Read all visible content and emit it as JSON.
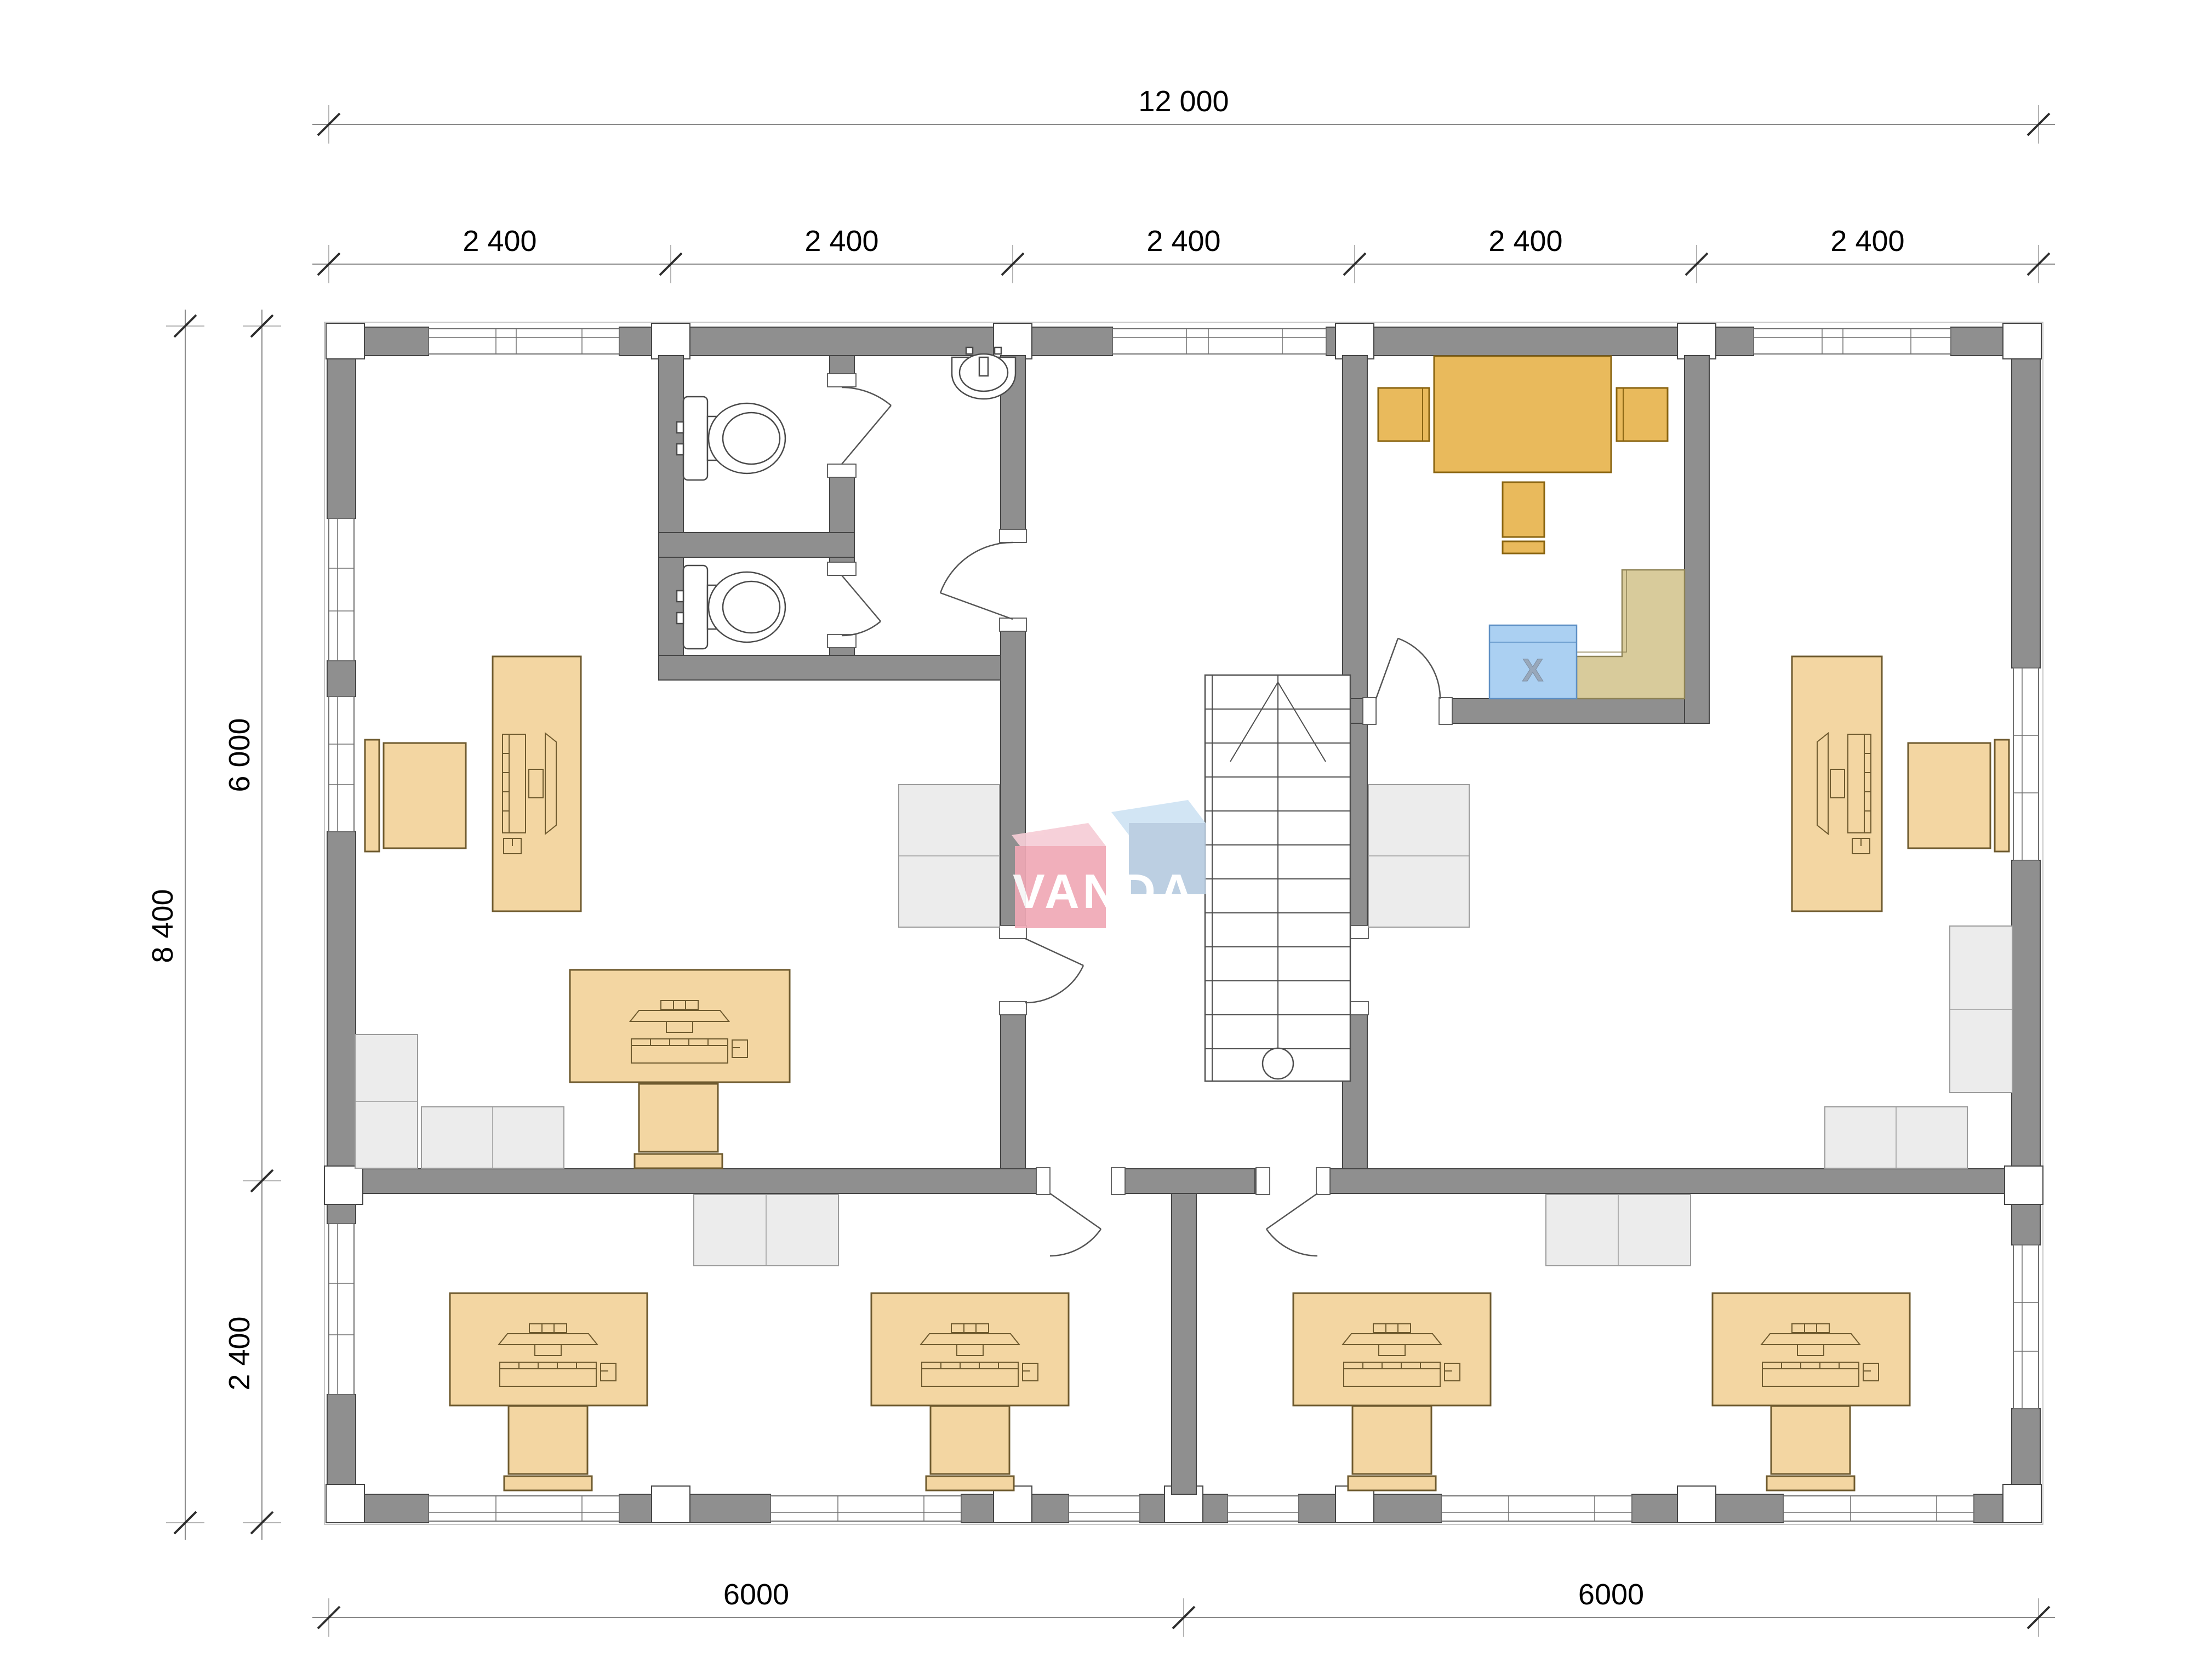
{
  "logo": {
    "text": "VANDA"
  },
  "dimensions": {
    "top_total": "12 000",
    "top_bays": [
      "2 400",
      "2 400",
      "2 400",
      "2 400",
      "2 400"
    ],
    "left_total": "8 400",
    "left_upper": "6 000",
    "left_lower": "2 400",
    "bottom_left": "6000",
    "bottom_right": "6000"
  },
  "kitchen": {
    "appliance_mark": "X"
  },
  "colors": {
    "wall_gray": "#8f8f8f",
    "furniture_tan": "#f3d6a2",
    "kitchen_orange": "#e9ba5c",
    "counter_tan": "#d8cb9b",
    "appliance_blue": "#abd0f2",
    "cabinet_gray": "#ececec",
    "logo_pink": "#f0a9b6",
    "logo_blue": "#b7cbe0"
  }
}
